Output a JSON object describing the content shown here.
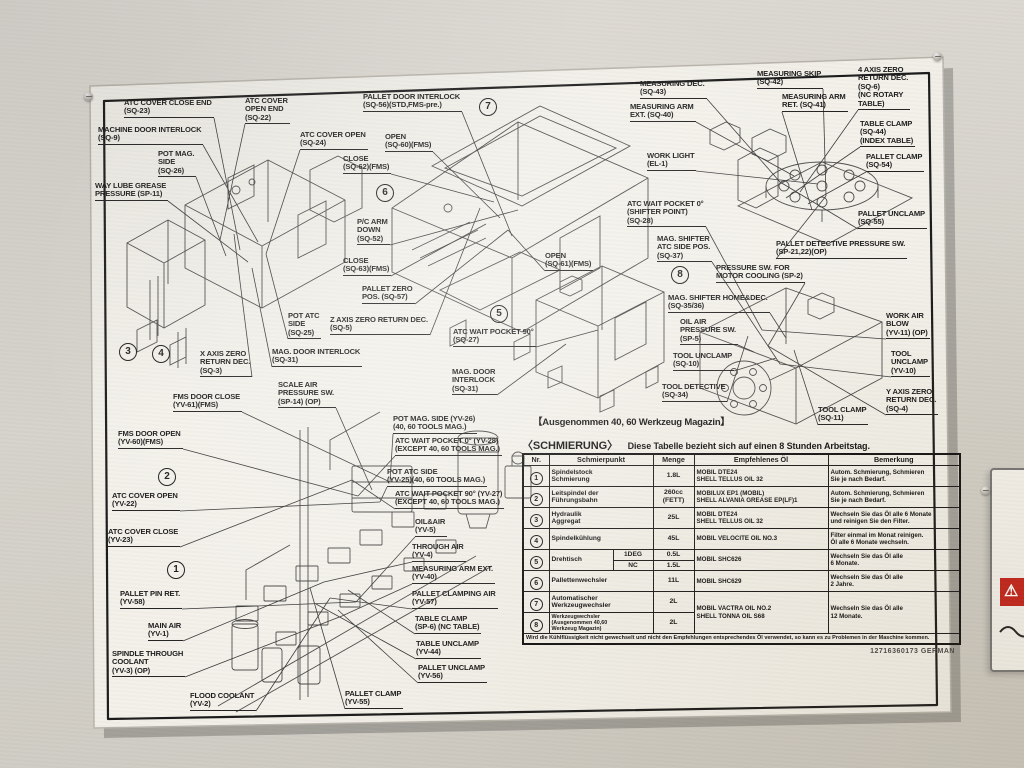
{
  "plate": {
    "part_number": "12716360173  GERMAN"
  },
  "caption": "【Ausgenommen 40, 60 Werkzeug Magazin】",
  "adjacent_label": {
    "warning_icon": "⚠"
  },
  "anchors": {
    "m1": [
      240,
      250
    ],
    "m2": [
      500,
      218
    ],
    "m3": [
      800,
      192
    ],
    "m4": [
      768,
      346
    ],
    "m5": [
      580,
      338
    ],
    "m6": [
      330,
      598
    ],
    "m6b": [
      372,
      490
    ]
  },
  "callouts": [
    {
      "x": 124,
      "y": 99,
      "anchor": "m1",
      "lines": [
        "ATC COVER CLOSE END",
        "(SQ-23)"
      ]
    },
    {
      "x": 98,
      "y": 126,
      "anchor": "m1",
      "lines": [
        "MACHINE DOOR INTERLOCK",
        "(SQ-9)"
      ]
    },
    {
      "x": 158,
      "y": 150,
      "anchor": "m1",
      "lines": [
        "POT MAG.",
        "SIDE",
        "(SQ-26)"
      ]
    },
    {
      "x": 95,
      "y": 182,
      "anchor": "m1",
      "lines": [
        "WAY LUBE GREASE",
        "PRESSURE  (SP-11)"
      ]
    },
    {
      "x": 245,
      "y": 97,
      "anchor": "m1",
      "lines": [
        "ATC COVER",
        "OPEN END",
        "(SQ-22)"
      ]
    },
    {
      "x": 300,
      "y": 131,
      "anchor": "m1",
      "lines": [
        "ATC COVER OPEN",
        "(SQ-24)"
      ]
    },
    {
      "x": 343,
      "y": 155,
      "anchor": "m2",
      "lines": [
        "CLOSE",
        "(SQ-62)(FMS)"
      ]
    },
    {
      "x": 363,
      "y": 93,
      "anchor": "m2",
      "lines": [
        "PALLET DOOR INTERLOCK",
        "(SQ-56)(STD,FMS-pre.)"
      ]
    },
    {
      "x": 385,
      "y": 133,
      "anchor": "m2",
      "lines": [
        "OPEN",
        "(SQ-60)(FMS)"
      ]
    },
    {
      "x": 357,
      "y": 218,
      "anchor": "m2",
      "lines": [
        "P/C ARM",
        "DOWN",
        "(SQ-52)"
      ]
    },
    {
      "x": 343,
      "y": 257,
      "anchor": "m2",
      "lines": [
        "CLOSE",
        "(SQ-63)(FMS)"
      ]
    },
    {
      "x": 362,
      "y": 285,
      "anchor": "m2",
      "lines": [
        "PALLET ZERO",
        "POS. (SQ-57)"
      ]
    },
    {
      "x": 330,
      "y": 316,
      "anchor": "m2",
      "lines": [
        "Z AXIS ZERO RETURN DEC.",
        "(SQ-5)"
      ]
    },
    {
      "x": 288,
      "y": 312,
      "anchor": "m1",
      "lines": [
        "POT ATC",
        "SIDE",
        "(SQ-25)"
      ]
    },
    {
      "x": 200,
      "y": 350,
      "anchor": "m1",
      "lines": [
        "X AXIS ZERO",
        "RETURN DEC.",
        "(SQ-3)"
      ]
    },
    {
      "x": 272,
      "y": 348,
      "anchor": "m1",
      "lines": [
        "MAG. DOOR INTERLOCK",
        "(SQ-31)"
      ]
    },
    {
      "x": 278,
      "y": 381,
      "anchor": "m6b",
      "lines": [
        "SCALE AIR",
        "PRESSURE SW.",
        "(SP-14) (OP)"
      ]
    },
    {
      "x": 453,
      "y": 328,
      "anchor": "m5",
      "lines": [
        "ATC WAIT POCKET 90°",
        "(SQ-27)"
      ]
    },
    {
      "x": 452,
      "y": 368,
      "anchor": "m5",
      "lines": [
        "MAG. DOOR",
        "INTERLOCK",
        "(SQ-31)"
      ]
    },
    {
      "x": 545,
      "y": 252,
      "anchor": "m2",
      "lines": [
        "OPEN",
        "(SQ-61)(FMS)"
      ]
    },
    {
      "x": 640,
      "y": 80,
      "anchor": "m3",
      "lines": [
        "MEASURING DEC.",
        "(SQ-43)"
      ]
    },
    {
      "x": 757,
      "y": 70,
      "anchor": "m3",
      "lines": [
        "MEASURING SKIP",
        "(SQ-42)"
      ]
    },
    {
      "x": 630,
      "y": 103,
      "anchor": "m3",
      "lines": [
        "MEASURING ARM",
        "EXT. (SQ-40)"
      ]
    },
    {
      "x": 782,
      "y": 93,
      "anchor": "m3",
      "lines": [
        "MEASURING ARM",
        "RET. (SQ-41)"
      ]
    },
    {
      "x": 858,
      "y": 66,
      "anchor": "m3",
      "lines": [
        "4 AXIS ZERO",
        "RETURN DEC.",
        "(SQ-6)",
        "(NC ROTARY",
        "TABLE)"
      ]
    },
    {
      "x": 647,
      "y": 152,
      "anchor": "m3",
      "lines": [
        "WORK LIGHT",
        "(EL-1)"
      ]
    },
    {
      "x": 860,
      "y": 120,
      "anchor": "m3",
      "lines": [
        "TABLE CLAMP",
        "(SQ-44)",
        "(INDEX TABLE)"
      ]
    },
    {
      "x": 866,
      "y": 153,
      "anchor": "m3",
      "lines": [
        "PALLET CLAMP",
        "(SQ-54)"
      ]
    },
    {
      "x": 858,
      "y": 210,
      "anchor": "m3",
      "lines": [
        "PALLET UNCLAMP",
        "(SQ-55)"
      ]
    },
    {
      "x": 776,
      "y": 240,
      "anchor": "m3",
      "lines": [
        "PALLET DETECTIVE PRESSURE SW.",
        "(SP-21,22)(OP)"
      ]
    },
    {
      "x": 627,
      "y": 200,
      "anchor": "m4",
      "lines": [
        "ATC WAIT POCKET 0°",
        "(SHIFTER POINT)",
        "(SQ-28)"
      ]
    },
    {
      "x": 657,
      "y": 235,
      "anchor": "m4",
      "lines": [
        "MAG. SHIFTER",
        "ATC SIDE POS.",
        "(SQ-37)"
      ]
    },
    {
      "x": 716,
      "y": 264,
      "anchor": "m4",
      "lines": [
        "PRESSURE SW. FOR",
        "MOTOR COOLING (SP-2)"
      ]
    },
    {
      "x": 668,
      "y": 294,
      "anchor": "m4",
      "lines": [
        "MAG. SHIFTER HOME&DEC.",
        "(SQ-35/36)"
      ]
    },
    {
      "x": 680,
      "y": 318,
      "anchor": "m4",
      "lines": [
        "OIL AIR",
        "PRESSURE SW.",
        "(SP-5)"
      ]
    },
    {
      "x": 673,
      "y": 352,
      "anchor": "m4",
      "lines": [
        "TOOL UNCLAMP",
        "(SQ-10)"
      ]
    },
    {
      "x": 662,
      "y": 383,
      "anchor": "m4",
      "lines": [
        "TOOL DETECTIVE",
        "(SQ-34)"
      ]
    },
    {
      "x": 818,
      "y": 406,
      "anchor": "m4",
      "lines": [
        "TOOL CLAMP",
        "(SQ-11)"
      ]
    },
    {
      "x": 886,
      "y": 312,
      "anchor": "m4",
      "lines": [
        "WORK AIR",
        "BLOW",
        "(YV-11) (OP)"
      ]
    },
    {
      "x": 891,
      "y": 350,
      "anchor": "m4",
      "lines": [
        "TOOL",
        "UNCLAMP",
        "(YV-10)"
      ]
    },
    {
      "x": 886,
      "y": 388,
      "anchor": "m4",
      "lines": [
        "Y AXIS ZERO",
        "RETURN DEC.",
        "(SQ-4)"
      ]
    },
    {
      "x": 173,
      "y": 393,
      "anchor": "m6b",
      "lines": [
        "FMS DOOR CLOSE",
        "(YV-61)(FMS)"
      ]
    },
    {
      "x": 118,
      "y": 430,
      "anchor": "m6b",
      "lines": [
        "FMS DOOR OPEN",
        "(YV-60)(FMS)"
      ]
    },
    {
      "x": 112,
      "y": 492,
      "anchor": "m6b",
      "lines": [
        "ATC COVER OPEN",
        "(YV-22)"
      ]
    },
    {
      "x": 108,
      "y": 528,
      "anchor": "m6b",
      "lines": [
        "ATC COVER CLOSE",
        "(YV-23)"
      ]
    },
    {
      "x": 120,
      "y": 590,
      "anchor": "m6",
      "lines": [
        "PALLET PIN RET.",
        "(YV-58)"
      ]
    },
    {
      "x": 148,
      "y": 622,
      "anchor": "m6",
      "lines": [
        "MAIN AIR",
        "(YV-1)"
      ]
    },
    {
      "x": 112,
      "y": 650,
      "anchor": "m6",
      "lines": [
        "SPINDLE THROUGH",
        "COOLANT",
        "(YV-3) (OP)"
      ]
    },
    {
      "x": 190,
      "y": 692,
      "anchor": "m6",
      "lines": [
        "FLOOD COOLANT",
        "(YV-2)"
      ]
    },
    {
      "x": 393,
      "y": 415,
      "anchor": "m6b",
      "lines": [
        "POT MAG. SIDE   (YV-26)",
        "(40, 60 TOOLS MAG.)"
      ]
    },
    {
      "x": 395,
      "y": 437,
      "anchor": "m6b",
      "lines": [
        "ATC WAIT POCKET 0° (YV-28)",
        "(EXCEPT 40, 60 TOOLS MAG.)"
      ]
    },
    {
      "x": 387,
      "y": 468,
      "anchor": "m6b",
      "lines": [
        "POT ATC SIDE",
        "(YV-25)(40, 60 TOOLS MAG.)"
      ]
    },
    {
      "x": 395,
      "y": 490,
      "anchor": "m6b",
      "lines": [
        "ATC WAIT POCKET 90° (YV-27)",
        "(EXCEPT 40, 60 TOOLS MAG.)"
      ]
    },
    {
      "x": 415,
      "y": 518,
      "anchor": "m6",
      "lines": [
        "OIL&AIR",
        "(YV-5)"
      ]
    },
    {
      "x": 412,
      "y": 543,
      "anchor": "m6",
      "lines": [
        "THROUGH AIR",
        "(YV-4)"
      ]
    },
    {
      "x": 412,
      "y": 565,
      "anchor": "m6",
      "lines": [
        "MEASURING ARM EXT.",
        "(YV-40)"
      ]
    },
    {
      "x": 412,
      "y": 590,
      "anchor": "m6",
      "lines": [
        "PALLET CLAMPING AIR",
        "(YV-57)"
      ]
    },
    {
      "x": 415,
      "y": 615,
      "anchor": "m6",
      "lines": [
        "TABLE CLAMP",
        "(SP-6) (NC TABLE)"
      ]
    },
    {
      "x": 416,
      "y": 640,
      "anchor": "m6",
      "lines": [
        "TABLE UNCLAMP",
        "(YV-44)"
      ]
    },
    {
      "x": 418,
      "y": 664,
      "anchor": "m6",
      "lines": [
        "PALLET UNCLAMP",
        "(YV-56)"
      ]
    },
    {
      "x": 345,
      "y": 690,
      "anchor": "m6",
      "lines": [
        "PALLET CLAMP",
        "(YV-55)"
      ]
    }
  ],
  "circled_numbers": [
    {
      "n": "1",
      "x": 167,
      "y": 561
    },
    {
      "n": "2",
      "x": 158,
      "y": 468
    },
    {
      "n": "3",
      "x": 119,
      "y": 343
    },
    {
      "n": "4",
      "x": 152,
      "y": 345
    },
    {
      "n": "5",
      "x": 490,
      "y": 305
    },
    {
      "n": "6",
      "x": 376,
      "y": 184
    },
    {
      "n": "7",
      "x": 479,
      "y": 98
    },
    {
      "n": "8",
      "x": 671,
      "y": 266
    }
  ],
  "table": {
    "title_bracket": "〈SCHMIERUNG〉",
    "title_rest": "Diese Tabelle bezieht sich auf einen 8 Stunden Arbeitstag.",
    "headers": [
      "Nr.",
      "Schmierpunkt",
      "Menge",
      "Empfehlenes Öl",
      "Bemerkung"
    ],
    "rows": [
      [
        {
          "t": "1",
          "k": "nr"
        },
        {
          "t": "Spindelstock\nSchmierung",
          "k": "pkt",
          "c": 2
        },
        {
          "t": "1.8L",
          "k": "ctr"
        },
        {
          "t": "MOBIL DTE24\nSHELL TELLUS OIL 32",
          "k": "oil"
        },
        {
          "t": "Autom. Schmierung, Schmieren\nSie je nach Bedarf.",
          "k": "rem"
        }
      ],
      [
        {
          "t": "2",
          "k": "nr"
        },
        {
          "t": "Leitspindel der\nFührungsbahn",
          "k": "pkt",
          "c": 2
        },
        {
          "t": "260cc\n(FETT)",
          "k": "ctr"
        },
        {
          "t": "MOBILUX EP1  (MOBIL)\nSHELL ALVANIA GREASE EP(LF)1",
          "k": "oil"
        },
        {
          "t": "Autom. Schmierung, Schmieren\nSie je nach Bedarf.",
          "k": "rem"
        }
      ],
      [
        {
          "t": "3",
          "k": "nr"
        },
        {
          "t": "Hydraulik\nAggregat",
          "k": "pkt",
          "c": 2
        },
        {
          "t": "25L",
          "k": "ctr"
        },
        {
          "t": "MOBIL DTE24\nSHELL TELLUS OIL 32",
          "k": "oil"
        },
        {
          "t": "Wechseln Sie das Öl alle 6 Monate\nund reinigen Sie den Filter.",
          "k": "rem"
        }
      ],
      [
        {
          "t": "4",
          "k": "nr"
        },
        {
          "t": "Spindelkühlung",
          "k": "pkt",
          "c": 2
        },
        {
          "t": "45L",
          "k": "ctr"
        },
        {
          "t": "MOBIL VELOCITE OIL NO.3",
          "k": "oil"
        },
        {
          "t": "Filter einmal im Monat reinigen.\nÖl alle 6 Monate wechseln.",
          "k": "rem"
        }
      ],
      [
        {
          "t": "5",
          "k": "nr",
          "r": 2
        },
        {
          "t": "Drehtisch",
          "k": "pkt",
          "r": 2
        },
        {
          "t": "1DEG",
          "k": "sub"
        },
        {
          "t": "0.5L",
          "k": "ctr"
        },
        {
          "t": "MOBIL SHC626",
          "k": "oil",
          "r": 2
        },
        {
          "t": "Wechseln Sie das Öl alle\n6 Monate.",
          "k": "rem",
          "r": 2
        }
      ],
      [
        {
          "t": "NC",
          "k": "sub"
        },
        {
          "t": "1.5L",
          "k": "ctr"
        }
      ],
      [
        {
          "t": "6",
          "k": "nr"
        },
        {
          "t": "Pallettenwechsler",
          "k": "pkt",
          "c": 2
        },
        {
          "t": "11L",
          "k": "ctr"
        },
        {
          "t": "MOBIL SHC629",
          "k": "oil"
        },
        {
          "t": "Wechseln Sie das Öl alle\n2 Jahre.",
          "k": "rem"
        }
      ],
      [
        {
          "t": "7",
          "k": "nr"
        },
        {
          "t": "Automatischer\nWerkzeugwechsler",
          "k": "pkt",
          "c": 2
        },
        {
          "t": "2L",
          "k": "ctr"
        },
        {
          "t": "MOBIL VACTRA OIL NO.2\nSHELL TONNA OIL S68",
          "k": "oil",
          "r": 2
        },
        {
          "t": "Wechseln Sie das Öl alle\n12 Monate.",
          "k": "rem",
          "r": 2
        }
      ],
      [
        {
          "t": "8",
          "k": "nr"
        },
        {
          "t": "Werkzeugwechsler\n(Ausgenommen 40,60\nWerkzeug Magazin)",
          "k": "pkt-sm",
          "c": 2
        },
        {
          "t": "2L",
          "k": "ctr"
        }
      ]
    ],
    "footnote": "Wird die Kühlflüssigkeit nicht gewechselt und nicht den Empfehlungen entsprechendes Öl verwendet, so kann es zu Problemen in der Maschine kommen."
  }
}
